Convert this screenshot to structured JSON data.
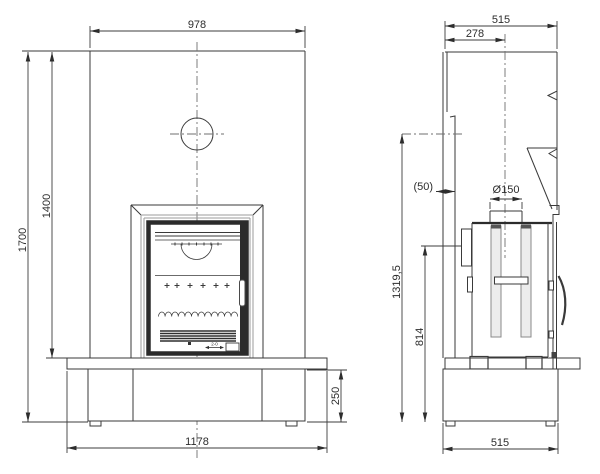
{
  "drawing": {
    "kind": "fireplace-technical-drawing",
    "views": [
      "front-elevation",
      "side-elevation"
    ],
    "units": "mm"
  },
  "front_view": {
    "dim_width_top": "978",
    "dim_height_overall": "1700",
    "dim_height_breast": "1400",
    "dim_hearth_width": "1178",
    "dim_plinth_height": "250",
    "door_micro_label": "2-0"
  },
  "side_view": {
    "dim_depth_top": "515",
    "dim_flue_center_offset": "278",
    "dim_wall_clearance": "(50)",
    "dim_flue_diameter": "Ø150",
    "dim_rear_outlet_height": "1319,5",
    "dim_shield_height": "814",
    "dim_base_depth": "515"
  },
  "colors": {
    "line": "#3a3a3a",
    "line_dark": "#2b2b2b",
    "line_light": "#9b9b9b",
    "centerline": "#6f6f6f",
    "background": "#ffffff"
  }
}
